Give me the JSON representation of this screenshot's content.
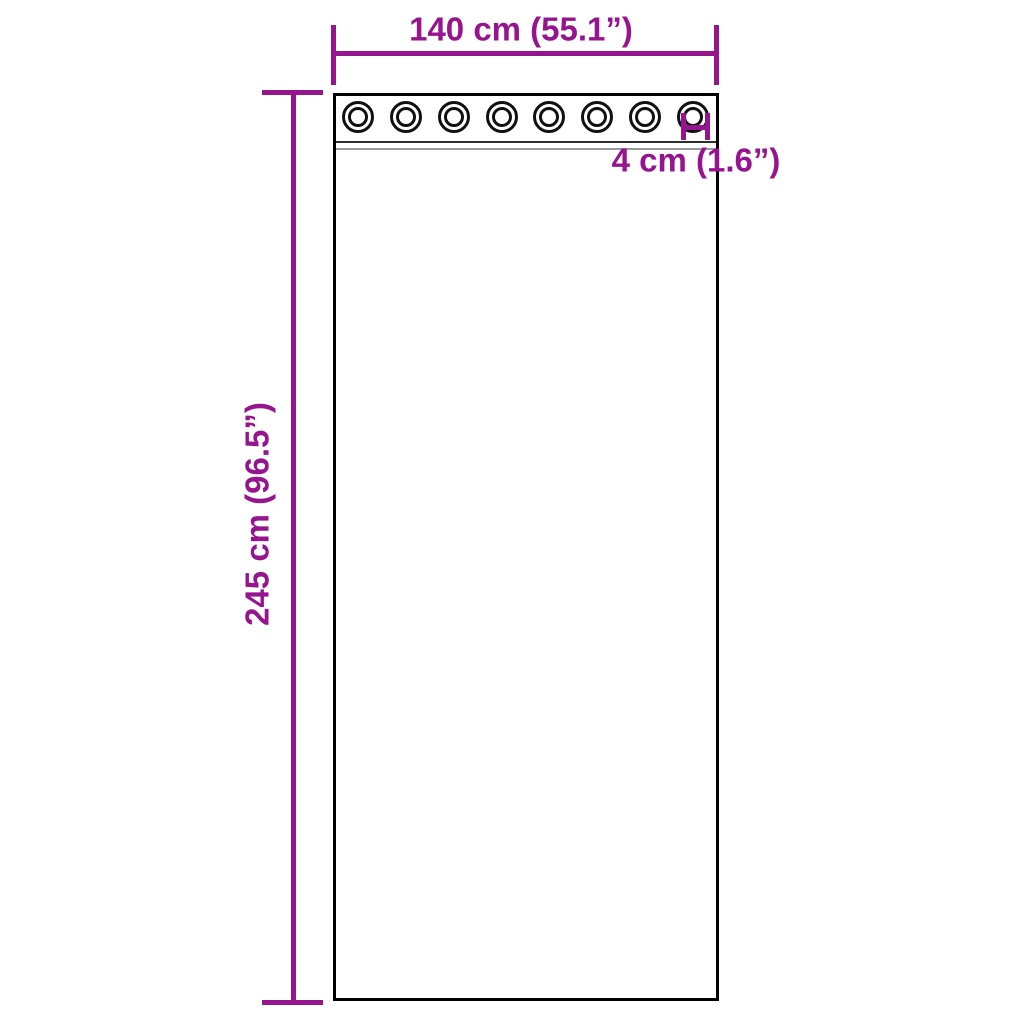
{
  "diagram": {
    "type": "product-dimension-diagram",
    "subject": "curtain panel with grommets",
    "colors": {
      "accent": "#96158F",
      "outline": "#000000",
      "background": "#FFFFFF"
    },
    "grommets": {
      "count": 8
    },
    "dimensions": {
      "width": {
        "label": "140 cm (55.1”)",
        "cm": 140,
        "inches": 55.1
      },
      "height": {
        "label": "245 cm (96.5”)",
        "cm": 245,
        "inches": 96.5
      },
      "grommet_edge_spacing": {
        "label": "4 cm (1.6”)",
        "cm": 4,
        "inches": 1.6
      }
    }
  }
}
